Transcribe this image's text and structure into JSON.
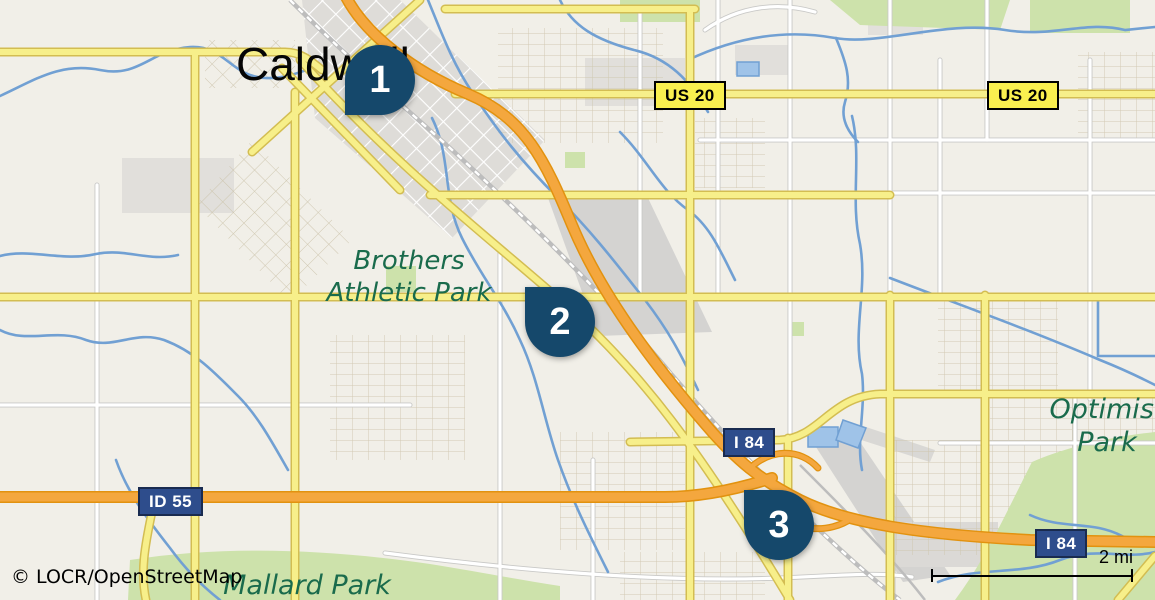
{
  "map": {
    "city_label": "Caldwell",
    "attribution": "© LOCR/OpenStreetMap",
    "scale": {
      "label": "2 mi"
    },
    "markers": [
      {
        "number": "1",
        "tail": "bottom-left"
      },
      {
        "number": "2",
        "tail": "top-left"
      },
      {
        "number": "3",
        "tail": "top-left"
      }
    ],
    "road_badges": [
      {
        "label": "US 20",
        "type": "us-route"
      },
      {
        "label": "US 20",
        "type": "us-route"
      },
      {
        "label": "I 84",
        "type": "interstate"
      },
      {
        "label": "I 84",
        "type": "interstate"
      },
      {
        "label": "ID 55",
        "type": "state-route"
      }
    ],
    "place_labels": {
      "brothers": {
        "line1": "Brothers",
        "line2": "Athletic Park"
      },
      "optimist": {
        "line1": "Optimist",
        "line2": "Park"
      },
      "mallard": {
        "line1": "Mallard Park"
      }
    },
    "colors": {
      "marker": "#15486b",
      "interstate_badge": "#2e4d8c",
      "us_badge": "#f9ef4f",
      "motorway": "#f4a73e",
      "secondary_road": "#f7ef8a",
      "water": "#71a0d3",
      "park": "#cde2ab",
      "park_label_text": "#1a6b4c",
      "background": "#f1efe8"
    }
  }
}
